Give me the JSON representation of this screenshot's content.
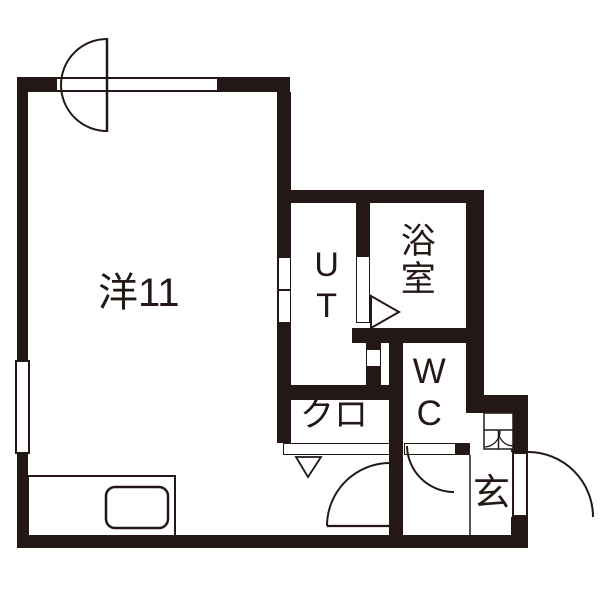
{
  "plan": {
    "type": "apartment-floor-plan",
    "colors": {
      "wall": "#231815",
      "background": "#ffffff",
      "ink": "#231815"
    },
    "rooms": {
      "living": {
        "label": "洋11"
      },
      "utility": {
        "label": "UT"
      },
      "bath": {
        "label": "浴室"
      },
      "toilet": {
        "label": "WC"
      },
      "closet": {
        "label": "クロ"
      },
      "entrance": {
        "label": "玄"
      }
    },
    "fixtures": [
      "swing-door-arc-top-window-wall",
      "window-top-wall",
      "window-left-wall",
      "kitchen-counter-with-sink",
      "sliding-door-living-to-utility",
      "bath-folding-door-triangle",
      "closet-folding-door-with-arrow",
      "hall-swing-door-arc",
      "wc-swing-door-arc",
      "entrance-swing-door-arc",
      "shoe-cabinet-double-doors"
    ]
  }
}
